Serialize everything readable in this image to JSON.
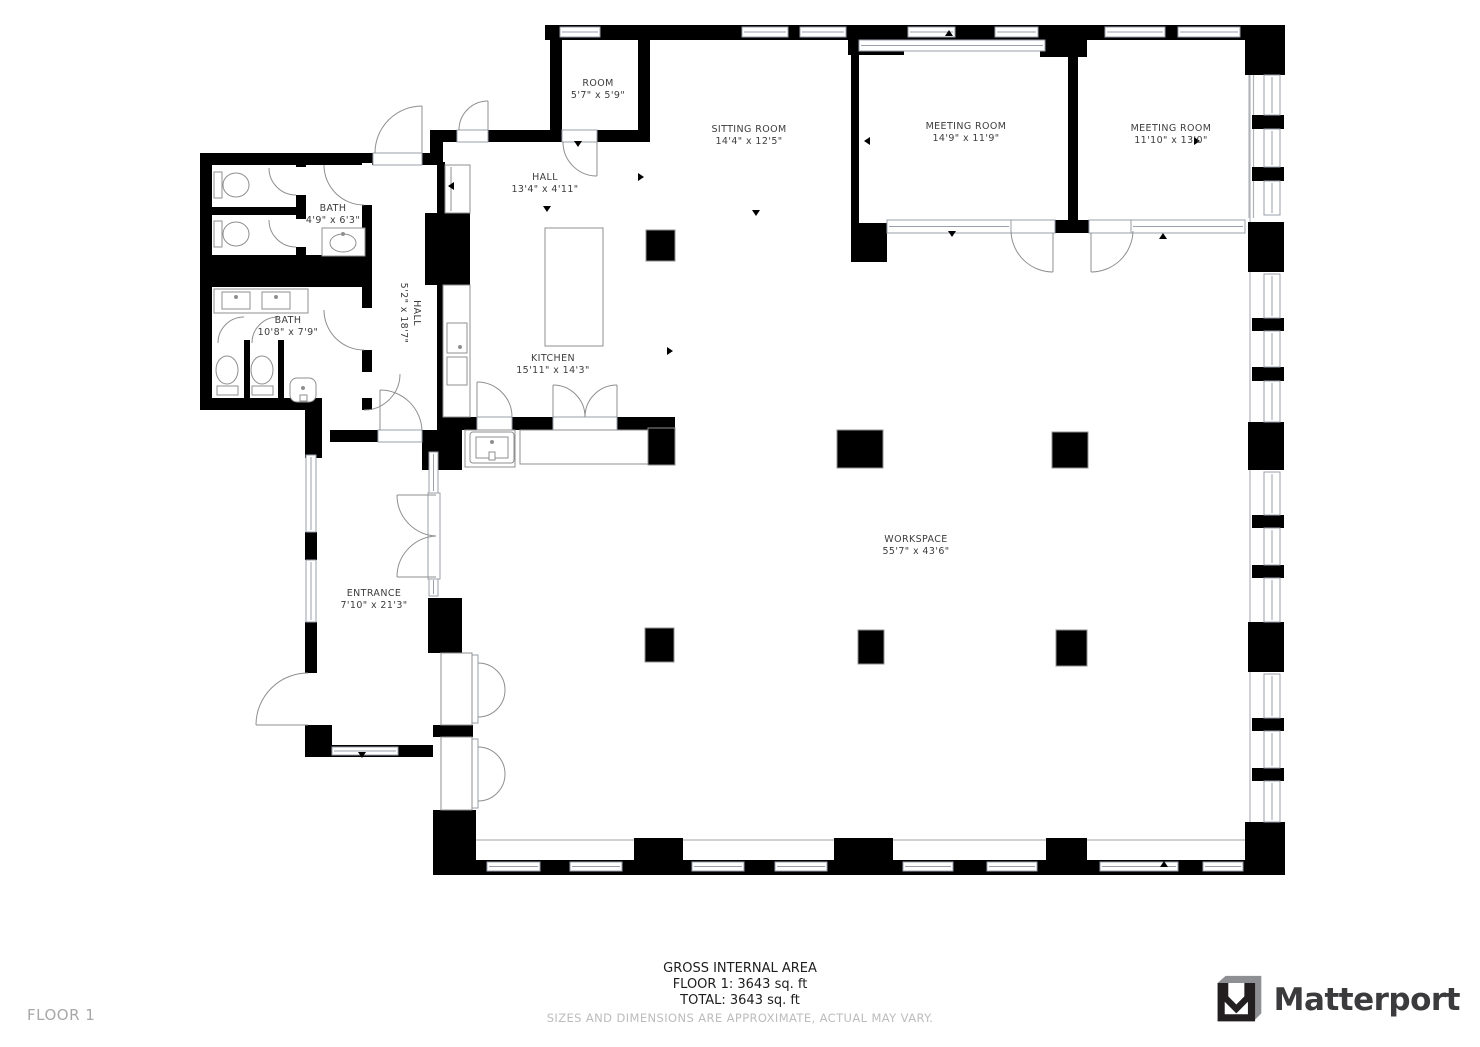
{
  "rooms": {
    "room": {
      "name": "ROOM",
      "dims": "5'7\" x 5'9\""
    },
    "sitting_room": {
      "name": "SITTING ROOM",
      "dims": "14'4\" x 12'5\""
    },
    "meeting_room_1": {
      "name": "MEETING ROOM",
      "dims": "14'9\" x 11'9\""
    },
    "meeting_room_2": {
      "name": "MEETING ROOM",
      "dims": "11'10\" x 13'0\""
    },
    "hall_top": {
      "name": "HALL",
      "dims": "13'4\" x 4'11\""
    },
    "bath_small": {
      "name": "BATH",
      "dims": "4'9\" x 6'3\""
    },
    "bath_large": {
      "name": "BATH",
      "dims": "10'8\" x 7'9\""
    },
    "hall_vertical": {
      "name": "HALL",
      "dims": "5'2\" x 18'7\""
    },
    "kitchen": {
      "name": "KITCHEN",
      "dims": "15'11\" x 14'3\""
    },
    "entrance": {
      "name": "ENTRANCE",
      "dims": "7'10\" x 21'3\""
    },
    "workspace": {
      "name": "WORKSPACE",
      "dims": "55'7\" x 43'6\""
    }
  },
  "footer": {
    "gross_internal_area_label": "GROSS INTERNAL AREA",
    "floor_line": "FLOOR 1: 3643 sq. ft",
    "total_line": "TOTAL: 3643 sq. ft",
    "disclaimer": "SIZES AND DIMENSIONS ARE APPROXIMATE, ACTUAL MAY VARY.",
    "floor_label": "FLOOR 1"
  },
  "branding": {
    "logo_text": "Matterport",
    "logo_icon": "matterport-m-icon"
  },
  "colors": {
    "wall": "#000000",
    "window_frame": "#9aa0ab",
    "door_stroke": "#8f8f8f",
    "fixture_stroke": "#8f8f8f",
    "label_text": "#3d3d3d",
    "disclaimer_text": "#bcbcbc",
    "floor_label_text": "#a8a8a8",
    "logo_text_color": "#3b3b3d",
    "logo_gray": "#8d8f92"
  }
}
